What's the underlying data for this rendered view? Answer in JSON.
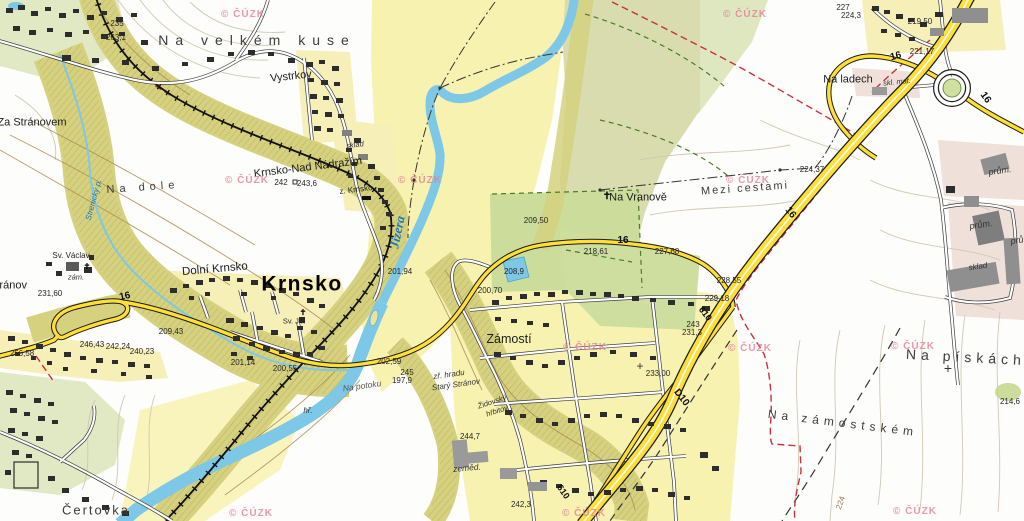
{
  "map": {
    "watermark_text": "© ČÚZK",
    "colors": {
      "floodplain_yellow": "#f8f2b0",
      "pale_green": "#e0e8c4",
      "bright_green": "#cbdc9b",
      "olive_field": "#d8dcae",
      "woodland": "#d5d17f",
      "river_blue": "#7cc8e6",
      "road_yellow": "#ffdf35",
      "boundary_red": "#c8323c",
      "watermark_pink": "#e48096"
    },
    "watermarks": [
      {
        "x": 243,
        "y": 15
      },
      {
        "x": 745,
        "y": 15
      },
      {
        "x": 247,
        "y": 181
      },
      {
        "x": 420,
        "y": 181
      },
      {
        "x": 748,
        "y": 181
      },
      {
        "x": 585,
        "y": 348
      },
      {
        "x": 750,
        "y": 349
      },
      {
        "x": 913,
        "y": 347
      },
      {
        "x": 251,
        "y": 514
      },
      {
        "x": 584,
        "y": 514
      },
      {
        "x": 915,
        "y": 512
      }
    ],
    "labels": [
      {
        "t": "Na velkém kuse",
        "n": "field-na-velkem-kuse",
        "x": 257,
        "y": 40,
        "cls": "field",
        "size": 14,
        "ls": 7
      },
      {
        "t": "Vystrkov",
        "n": "place-vystrkov",
        "x": 291,
        "y": 77,
        "cls": "place",
        "size": 11,
        "rot": -6
      },
      {
        "t": "Za Stránovem",
        "n": "place-za-stranovem",
        "x": 32,
        "y": 123,
        "cls": "place",
        "size": 11
      },
      {
        "t": "Krnsko-Nad Nádražím",
        "n": "place-krnsko-nad-nadrazim",
        "x": 308,
        "y": 168,
        "cls": "place",
        "size": 11,
        "rot": -7
      },
      {
        "t": "z. Krnsko",
        "n": "station-z-krnsko",
        "x": 356,
        "y": 190,
        "cls": "small",
        "size": 8,
        "rot": -7
      },
      {
        "t": "sklad",
        "n": "label-sklad-station",
        "x": 355,
        "y": 145,
        "cls": "smallit",
        "size": 7.5,
        "rot": -7
      },
      {
        "t": "Krnsko",
        "n": "town-krnsko",
        "x": 302,
        "y": 284,
        "cls": "town",
        "size": 21
      },
      {
        "t": "Dolní Krnsko",
        "n": "place-dolni-krnsko",
        "x": 215,
        "y": 270,
        "cls": "place",
        "size": 11.5,
        "rot": -5
      },
      {
        "t": "Sv. Václav",
        "n": "label-sv-vaclav",
        "x": 71,
        "y": 256,
        "cls": "small",
        "size": 8
      },
      {
        "t": "zám.",
        "n": "label-zamek",
        "x": 76,
        "y": 277,
        "cls": "smallit",
        "size": 7.5
      },
      {
        "t": "Sv. Jiří",
        "n": "label-sv-jiri",
        "x": 294,
        "y": 321,
        "cls": "small",
        "size": 7.5
      },
      {
        "t": "Na dole",
        "n": "field-na-dole",
        "x": 143,
        "y": 188,
        "cls": "field",
        "size": 11,
        "ls": 5,
        "rot": -4
      },
      {
        "t": "Stránov",
        "n": "place-stranov",
        "x": 8,
        "y": 286,
        "cls": "place",
        "size": 11
      },
      {
        "t": "Jizera",
        "n": "river-jizera",
        "x": 397,
        "y": 232,
        "cls": "water",
        "size": 13,
        "rot": -78
      },
      {
        "t": "Strenický p.",
        "n": "stream-strenicky",
        "x": 94,
        "y": 200,
        "cls": "waters",
        "size": 8,
        "rot": -75
      },
      {
        "t": "Zámostí",
        "n": "place-zamosti",
        "x": 509,
        "y": 339,
        "cls": "place",
        "size": 12.5
      },
      {
        "t": "Čertovka",
        "n": "field-certovka",
        "x": 96,
        "y": 510,
        "cls": "field",
        "size": 13,
        "ls": 2
      },
      {
        "t": "Na Vranově",
        "n": "place-na-vranove",
        "x": 638,
        "y": 198,
        "cls": "place",
        "size": 11
      },
      {
        "t": "Mezi cestami",
        "n": "field-mezi-cestami",
        "x": 745,
        "y": 189,
        "cls": "field",
        "size": 11,
        "ls": 2,
        "rot": -4
      },
      {
        "t": "Na ladech",
        "n": "place-na-ladech",
        "x": 848,
        "y": 80,
        "cls": "place",
        "size": 11
      },
      {
        "t": "Na pískách",
        "n": "field-na-piskach",
        "x": 966,
        "y": 357,
        "cls": "field",
        "size": 14,
        "ls": 5,
        "rot": 3
      },
      {
        "t": "Na zámostském",
        "n": "field-na-zamostskem",
        "x": 843,
        "y": 423,
        "cls": "field",
        "size": 12,
        "ls": 5,
        "rot": 7
      },
      {
        "t": "Na potoku",
        "n": "label-na-potoku",
        "x": 362,
        "y": 386,
        "cls": "smallg",
        "size": 8.5,
        "rot": -8
      },
      {
        "t": "zř. hradu",
        "n": "label-zr-hradu",
        "x": 449,
        "y": 375,
        "cls": "smallit",
        "size": 8,
        "rot": -8
      },
      {
        "t": "Starý Stránov",
        "n": "label-stary-stranov",
        "x": 456,
        "y": 385,
        "cls": "smallit",
        "size": 8,
        "rot": -8
      },
      {
        "t": "Židovský",
        "n": "label-zidovsky",
        "x": 492,
        "y": 402,
        "cls": "smallit",
        "size": 7.5,
        "rot": -18
      },
      {
        "t": "hřbitov",
        "n": "label-hrbitov",
        "x": 497,
        "y": 411,
        "cls": "smallit",
        "size": 7.5,
        "rot": -18
      },
      {
        "t": "hř.",
        "n": "label-hr",
        "x": 308,
        "y": 411,
        "cls": "smallit",
        "size": 8
      },
      {
        "t": "zeměd.",
        "n": "label-zemed",
        "x": 467,
        "y": 468,
        "cls": "smallit",
        "size": 8.5,
        "rot": -5
      },
      {
        "t": "prům.",
        "n": "label-prum-1",
        "x": 1000,
        "y": 171,
        "cls": "smallit",
        "size": 9,
        "rot": -8
      },
      {
        "t": "prům.",
        "n": "label-prum-2",
        "x": 981,
        "y": 225,
        "cls": "smallit",
        "size": 9,
        "rot": -8
      },
      {
        "t": "prům.",
        "n": "label-prum-3",
        "x": 1022,
        "y": 240,
        "cls": "smallit",
        "size": 9,
        "rot": -8
      },
      {
        "t": "sklad",
        "n": "label-sklad-prum",
        "x": 978,
        "y": 267,
        "cls": "smallit",
        "size": 8,
        "rot": -8
      },
      {
        "t": "skl. mat.",
        "n": "label-skl-mat",
        "x": 897,
        "y": 82,
        "cls": "smallit",
        "size": 7.5,
        "rot": -6
      },
      {
        "t": "16",
        "n": "road-16-a",
        "x": 125,
        "y": 297,
        "cls": "road",
        "size": 10,
        "rot": -12
      },
      {
        "t": "16",
        "n": "road-16-b",
        "x": 623,
        "y": 241,
        "cls": "road",
        "size": 10
      },
      {
        "t": "16",
        "n": "road-16-c",
        "x": 790,
        "y": 213,
        "cls": "road",
        "size": 10,
        "rot": 52
      },
      {
        "t": "16",
        "n": "road-16-d",
        "x": 896,
        "y": 57,
        "cls": "road",
        "size": 10,
        "rot": -15
      },
      {
        "t": "16",
        "n": "road-16-e",
        "x": 985,
        "y": 98,
        "cls": "road",
        "size": 10,
        "rot": 55
      },
      {
        "t": "D10",
        "n": "road-d10",
        "x": 681,
        "y": 398,
        "cls": "road",
        "size": 10,
        "rot": 52
      },
      {
        "t": "610",
        "n": "road-610-a",
        "x": 705,
        "y": 314,
        "cls": "road",
        "size": 9,
        "rot": 52
      },
      {
        "t": "610",
        "n": "road-610-b",
        "x": 563,
        "y": 492,
        "cls": "road",
        "size": 9,
        "rot": 55
      },
      {
        "t": "235",
        "x": 117,
        "y": 24,
        "cls": "elev"
      },
      {
        "t": "263,1",
        "x": 116,
        "y": 38,
        "cls": "elev"
      },
      {
        "t": "242",
        "x": 281,
        "y": 183,
        "cls": "elev"
      },
      {
        "t": "243,6",
        "x": 307,
        "y": 184,
        "cls": "elev"
      },
      {
        "t": "201,94",
        "x": 400,
        "y": 272,
        "cls": "elev"
      },
      {
        "t": "200,70",
        "x": 490,
        "y": 291,
        "cls": "elev"
      },
      {
        "t": "200,55",
        "x": 285,
        "y": 369,
        "cls": "elev"
      },
      {
        "t": "201,14",
        "x": 243,
        "y": 363,
        "cls": "elev"
      },
      {
        "t": "202,59",
        "x": 389,
        "y": 362,
        "cls": "elev"
      },
      {
        "t": "209,43",
        "x": 171,
        "y": 332,
        "cls": "elev"
      },
      {
        "t": "242,24",
        "x": 118,
        "y": 347,
        "cls": "elev"
      },
      {
        "t": "240,23",
        "x": 142,
        "y": 352,
        "cls": "elev"
      },
      {
        "t": "246,43",
        "x": 92,
        "y": 345,
        "cls": "elev"
      },
      {
        "t": "256,58",
        "x": 22,
        "y": 354,
        "cls": "elev"
      },
      {
        "t": "231,60",
        "x": 50,
        "y": 294,
        "cls": "elev"
      },
      {
        "t": "209,50",
        "x": 536,
        "y": 221,
        "cls": "elev"
      },
      {
        "t": "218,61",
        "x": 596,
        "y": 252,
        "cls": "elev"
      },
      {
        "t": "227,68",
        "x": 667,
        "y": 252,
        "cls": "elev"
      },
      {
        "t": "224,37",
        "x": 812,
        "y": 170,
        "cls": "elev"
      },
      {
        "t": "228,55",
        "x": 729,
        "y": 281,
        "cls": "elev"
      },
      {
        "t": "229,18",
        "x": 717,
        "y": 299,
        "cls": "elev"
      },
      {
        "t": "243",
        "x": 693,
        "y": 325,
        "cls": "elev"
      },
      {
        "t": "231,3",
        "x": 692,
        "y": 333,
        "cls": "elev"
      },
      {
        "t": "233,00",
        "x": 658,
        "y": 374,
        "cls": "elev"
      },
      {
        "t": "244,7",
        "x": 470,
        "y": 437,
        "cls": "elev"
      },
      {
        "t": "242,3",
        "x": 521,
        "y": 505,
        "cls": "elev"
      },
      {
        "t": "245",
        "x": 407,
        "y": 373,
        "cls": "elev"
      },
      {
        "t": "197,9",
        "x": 402,
        "y": 381,
        "cls": "elev"
      },
      {
        "t": "219,50",
        "x": 920,
        "y": 22,
        "cls": "elev"
      },
      {
        "t": "221,17",
        "x": 922,
        "y": 52,
        "cls": "elev"
      },
      {
        "t": "227",
        "x": 843,
        "y": 8,
        "cls": "elev"
      },
      {
        "t": "224,3",
        "x": 851,
        "y": 16,
        "cls": "elev"
      },
      {
        "t": "214,6",
        "x": 1010,
        "y": 402,
        "cls": "elev"
      },
      {
        "t": "208,9",
        "x": 514,
        "y": 272,
        "cls": "elev"
      },
      {
        "t": "224",
        "n": "contour-224",
        "x": 841,
        "y": 503,
        "cls": "contourlbl",
        "size": 8,
        "rot": -70
      },
      {
        "t": "✝",
        "n": "church-cross-na-vranove-icon",
        "x": 607,
        "y": 197,
        "cls": "sym",
        "size": 10
      },
      {
        "t": "✝",
        "n": "church-cross-sv-vaclav-icon",
        "x": 87,
        "y": 267,
        "cls": "sym",
        "size": 8
      },
      {
        "t": "✝",
        "n": "church-cross-krnsko-icon",
        "x": 303,
        "y": 313,
        "cls": "sym",
        "size": 8
      },
      {
        "t": "+",
        "n": "survey-cross-na-piskach-icon",
        "x": 948,
        "y": 368,
        "cls": "symx",
        "size": 14
      },
      {
        "t": "+",
        "n": "survey-cross-233-icon",
        "x": 640,
        "y": 366,
        "cls": "symx",
        "size": 12
      }
    ]
  }
}
